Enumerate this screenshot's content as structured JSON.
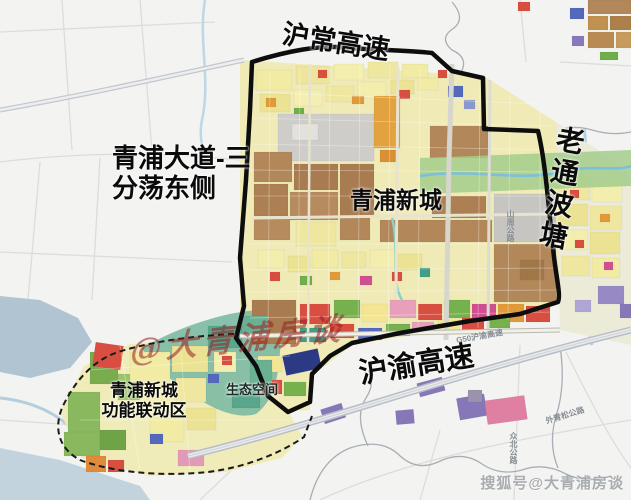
{
  "page": {
    "width": 631,
    "height": 500
  },
  "map": {
    "labels": {
      "top_expressway": "沪常高速",
      "left_road_line1": "青浦大道-三",
      "left_road_line2": "分荡东侧",
      "city_name": "青浦新城",
      "right_waterway": "老通波塘",
      "bottom_expressway": "沪渝高速",
      "linkage_line1": "青浦新城",
      "linkage_line2": "功能联动区",
      "eco_space": "生态空间"
    },
    "road_labels": {
      "g50": "G50沪渝高速",
      "shanzhou": "山周公路",
      "zhongbei": "众北公路",
      "waiqingsong": "外青松公路"
    },
    "watermarks": {
      "center": "@大青浦房谈",
      "bottom_right": "搜狐号@大青浦房谈"
    },
    "palette": {
      "boundary_black": "#0d0d0d",
      "residential_yellow": "#f1eba4",
      "commercial_brown": "#b2875a",
      "industrial_gray": "#cecdc9",
      "public_red": "#d84f42",
      "green_space": "#79ab4f",
      "eco_teal": "#58a68c",
      "water_blue": "#a9d2e2",
      "logistics_purple": "#8678b8",
      "mixed_orange": "#e2a23f",
      "pink_block": "#e39ab6",
      "background": "#f3f4f1"
    }
  }
}
